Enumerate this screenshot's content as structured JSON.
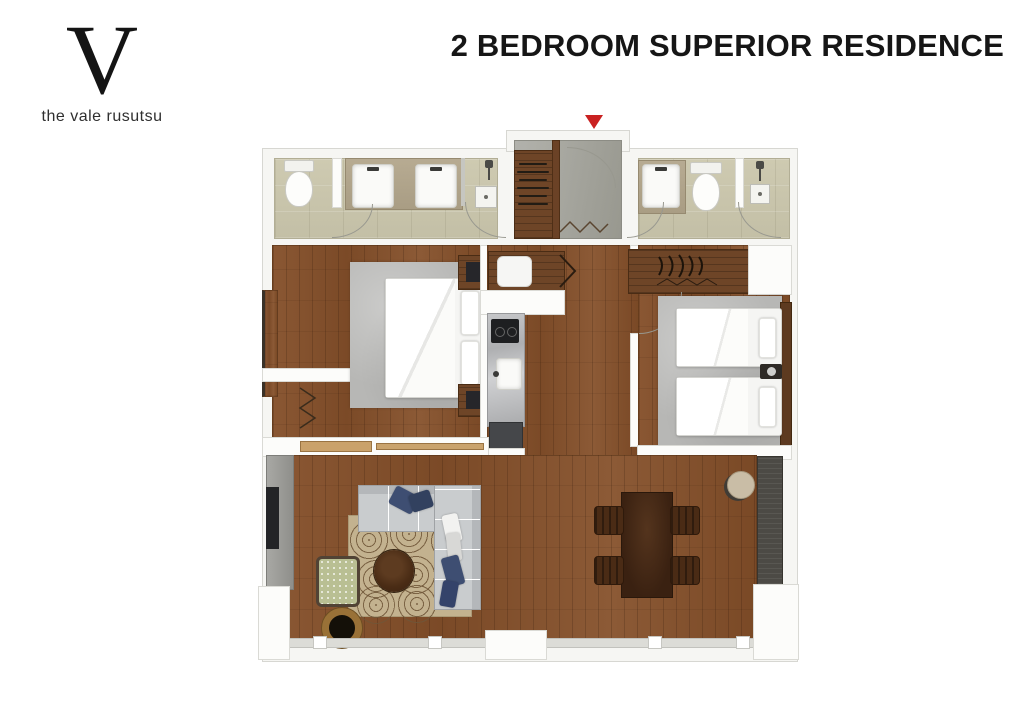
{
  "logo": {
    "letter": "V",
    "name": "the vale rusutsu"
  },
  "header": {
    "title": "2 BEDROOM SUPERIOR RESIDENCE"
  },
  "floorplan": {
    "icons": {
      "entrance_marker": "▼"
    },
    "colors": {
      "accent_red": "#c92121",
      "wood_floor": "#82512c",
      "bathroom_tile": "#c9c5ac",
      "entry_floor": "#a5a59d",
      "bedroom_rug": "#b7b7b5",
      "living_rug": "#c3b28f",
      "sofa_gray": "#c9ccce",
      "pillow_navy": "#3e4e72",
      "dining_table": "#3f2514",
      "kitchen_marble": "#b9babc",
      "armchair_green": "#b9bf93",
      "tv_unit_gray": "#9b9b97"
    }
  }
}
